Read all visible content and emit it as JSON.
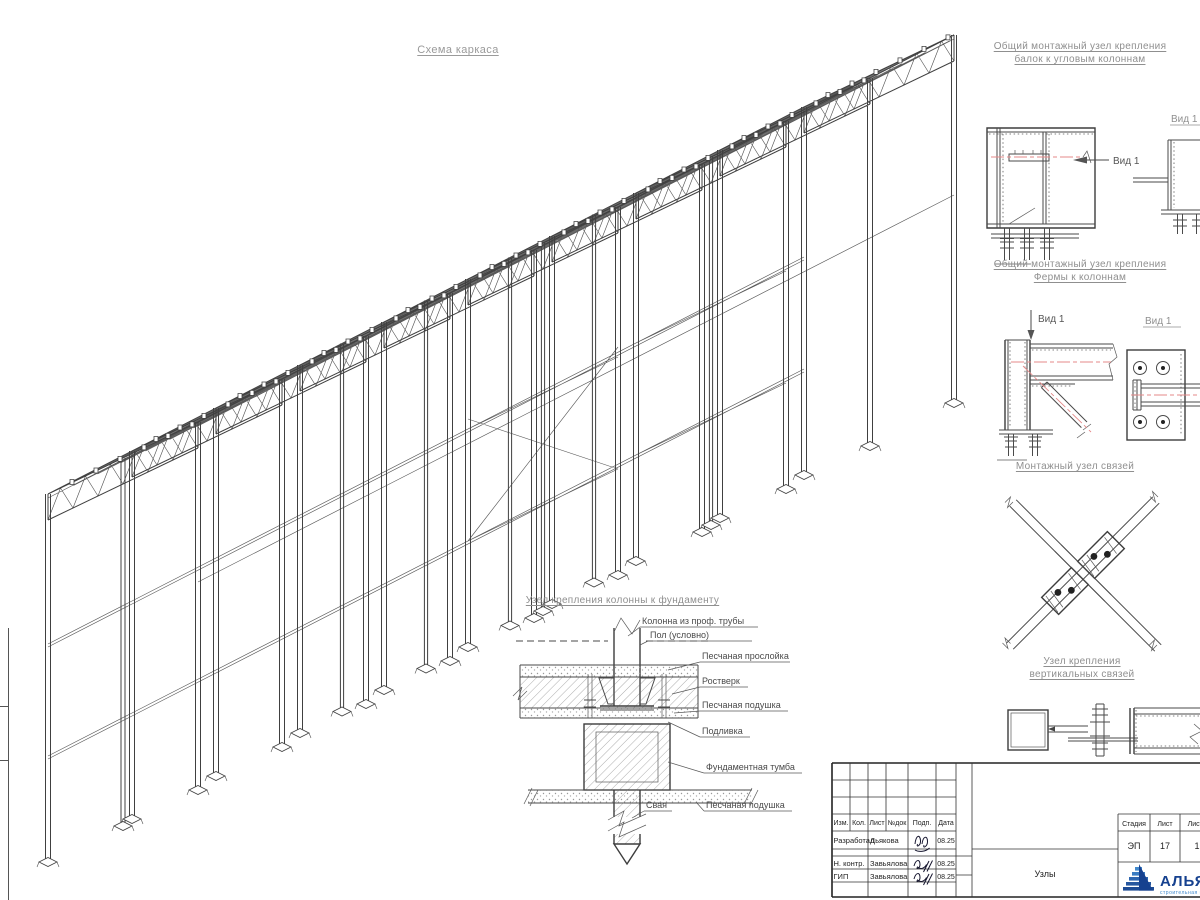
{
  "sheet": {
    "main_title": "Схема каркаса"
  },
  "details": {
    "corner_beam": {
      "title1": "Общий монтажный узел крепления",
      "title2": "балок к угловым колоннам",
      "view1": "Вид 1",
      "view2": "Вид 1"
    },
    "truss_column": {
      "title1": "Общий монтажный узел крепления",
      "title2": "Фермы к колоннам",
      "view_left": "Вид 1",
      "view_right": "Вид 1"
    },
    "bracing": {
      "title": "Монтажный узел связей"
    },
    "vertical_bracing": {
      "title1": "Узел крепления",
      "title2": "вертикальных связей"
    }
  },
  "foundation": {
    "title": "Узел крепления колонны к фундаменту",
    "labels": {
      "column": "Колонна из проф. трубы",
      "floor": "Пол (условно)",
      "sand_layer": "Песчаная прослойка",
      "grillage": "Ростверк",
      "sand_cushion": "Песчаная подушка",
      "grout": "Подливка",
      "pedestal": "Фундаментная тумба",
      "pile": "Свая",
      "sand_cushion2": "Песчаная подушка"
    }
  },
  "title_block": {
    "columns": [
      "Изм.",
      "Кол.",
      "Лист",
      "№док",
      "Подп.",
      "Дата"
    ],
    "rows": [
      {
        "role": "Разработал",
        "name": "Дьякова",
        "date": "08.25"
      },
      {
        "role": "Н. контр.",
        "name": "Завьялова",
        "date": "08.25"
      },
      {
        "role": "ГИП",
        "name": "Завьялова",
        "date": "08.25"
      }
    ],
    "stage_label": "Стадия",
    "sheet_label": "Лист",
    "sheets_label": "Листов",
    "stage": "ЭП",
    "sheet_no": "17",
    "sheets": "1",
    "doc_name": "Узлы",
    "company": "АЛЬЯНС",
    "company_sub": "строительная компания"
  },
  "colors": {
    "line": "#4a4a4a",
    "centerline": "#e58989",
    "heading": "#8f8f8f",
    "logo_blue": "#16418f",
    "logo_light": "#4189cc"
  }
}
